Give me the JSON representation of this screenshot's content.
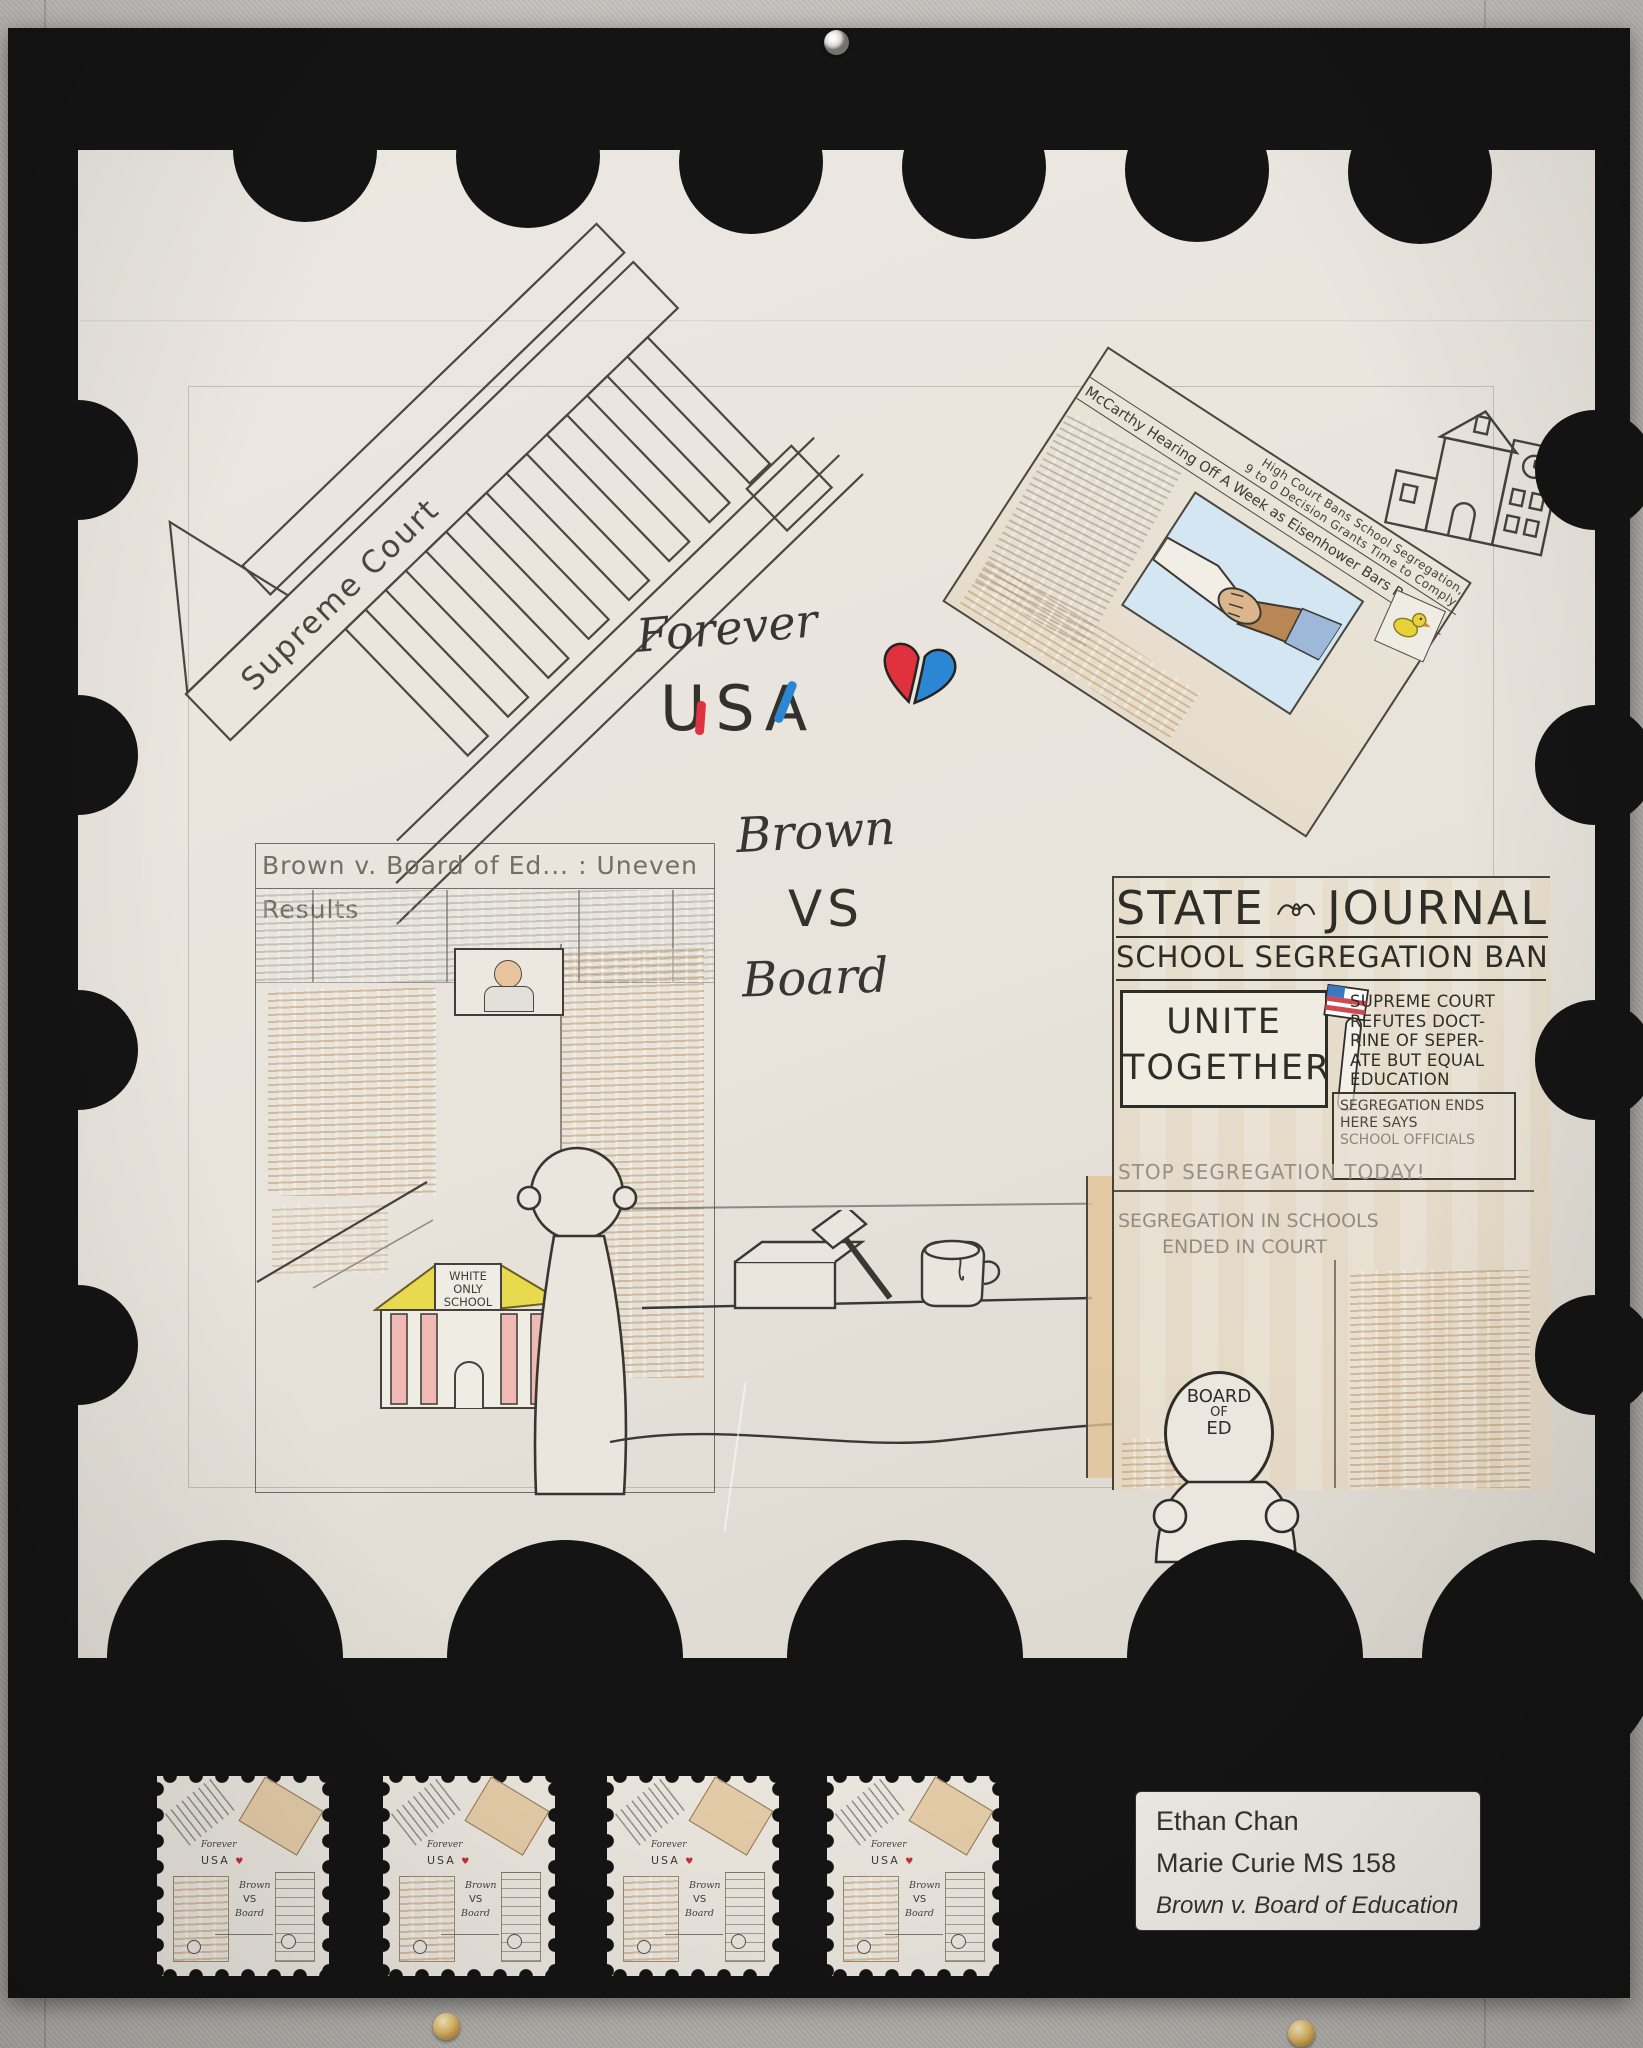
{
  "artwork": {
    "supreme_court_label": "Supreme Court",
    "top_right_news": {
      "headline_1": "High Court Bans School Segregation,",
      "headline_2": "9 to 0 Decision Grants Time to Comply",
      "headline_3": "McCarthy Hearing Off A Week as Eisenhower Bars Report"
    },
    "title": {
      "forever": "Forever",
      "usa_u": "U",
      "usa_s": "S",
      "usa_a": "A",
      "brown": "Brown",
      "vs": "VS",
      "board": "Board"
    },
    "left_news": {
      "headline": "Brown v. Board of Ed... : Uneven Results",
      "school_1": "WHITE",
      "school_2": "ONLY",
      "school_3": "SCHOOL"
    },
    "state_journal": {
      "masthead_state": "STATE",
      "masthead_journal": "JOURNAL",
      "headline": "SCHOOL SEGREGATION BANNED",
      "sign_1": "UNITE",
      "sign_2": "TOGETHER",
      "col_1": "SUPREME COURT",
      "col_2": "REFUTES DOCT-",
      "col_3": "RINE OF SEPER-",
      "col_4": "ATE BUT EQUAL",
      "col_5": "EDUCATION",
      "ends_1": "SEGREGATION ENDS",
      "ends_2": "HERE SAYS",
      "ends_3": "SCHOOL OFFICIALS",
      "stop_line": "STOP SEGREGATION TODAY!",
      "schools_1": "SEGREGATION IN SCHOOLS",
      "schools_2": "ENDED IN COURT",
      "head_1": "BOARD",
      "head_2": "OF",
      "head_3": "ED"
    }
  },
  "mini_stamp": {
    "forever": "Forever",
    "usa": "USA",
    "heart": "♥",
    "brown": "Brown",
    "vs": "VS",
    "board": "Board"
  },
  "label_card": {
    "name": "Ethan Chan",
    "school": "Marie Curie MS 158",
    "title": "Brown v. Board of Education"
  },
  "colors": {
    "poster_black": "#141414",
    "stamp_paper": "#e9e5dd",
    "wall_gray": "#bab7b2",
    "pencil_dark": "#3c3a34",
    "pencil_gray": "#8d8780",
    "article_tan": "#ddc096",
    "heart_red": "#e0323e",
    "heart_blue": "#2b87d3",
    "usa_red": "#e0323e",
    "usa_blue": "#2b87d3",
    "school_yellow": "#e8da4e",
    "school_pink": "#f0b9b4",
    "flag_blue": "#3b78c2",
    "flag_red": "#cf4a50",
    "sky_blue": "#d3e6f1",
    "bird_yellow": "#e8d23a",
    "pin_gold": "#dcb666"
  }
}
